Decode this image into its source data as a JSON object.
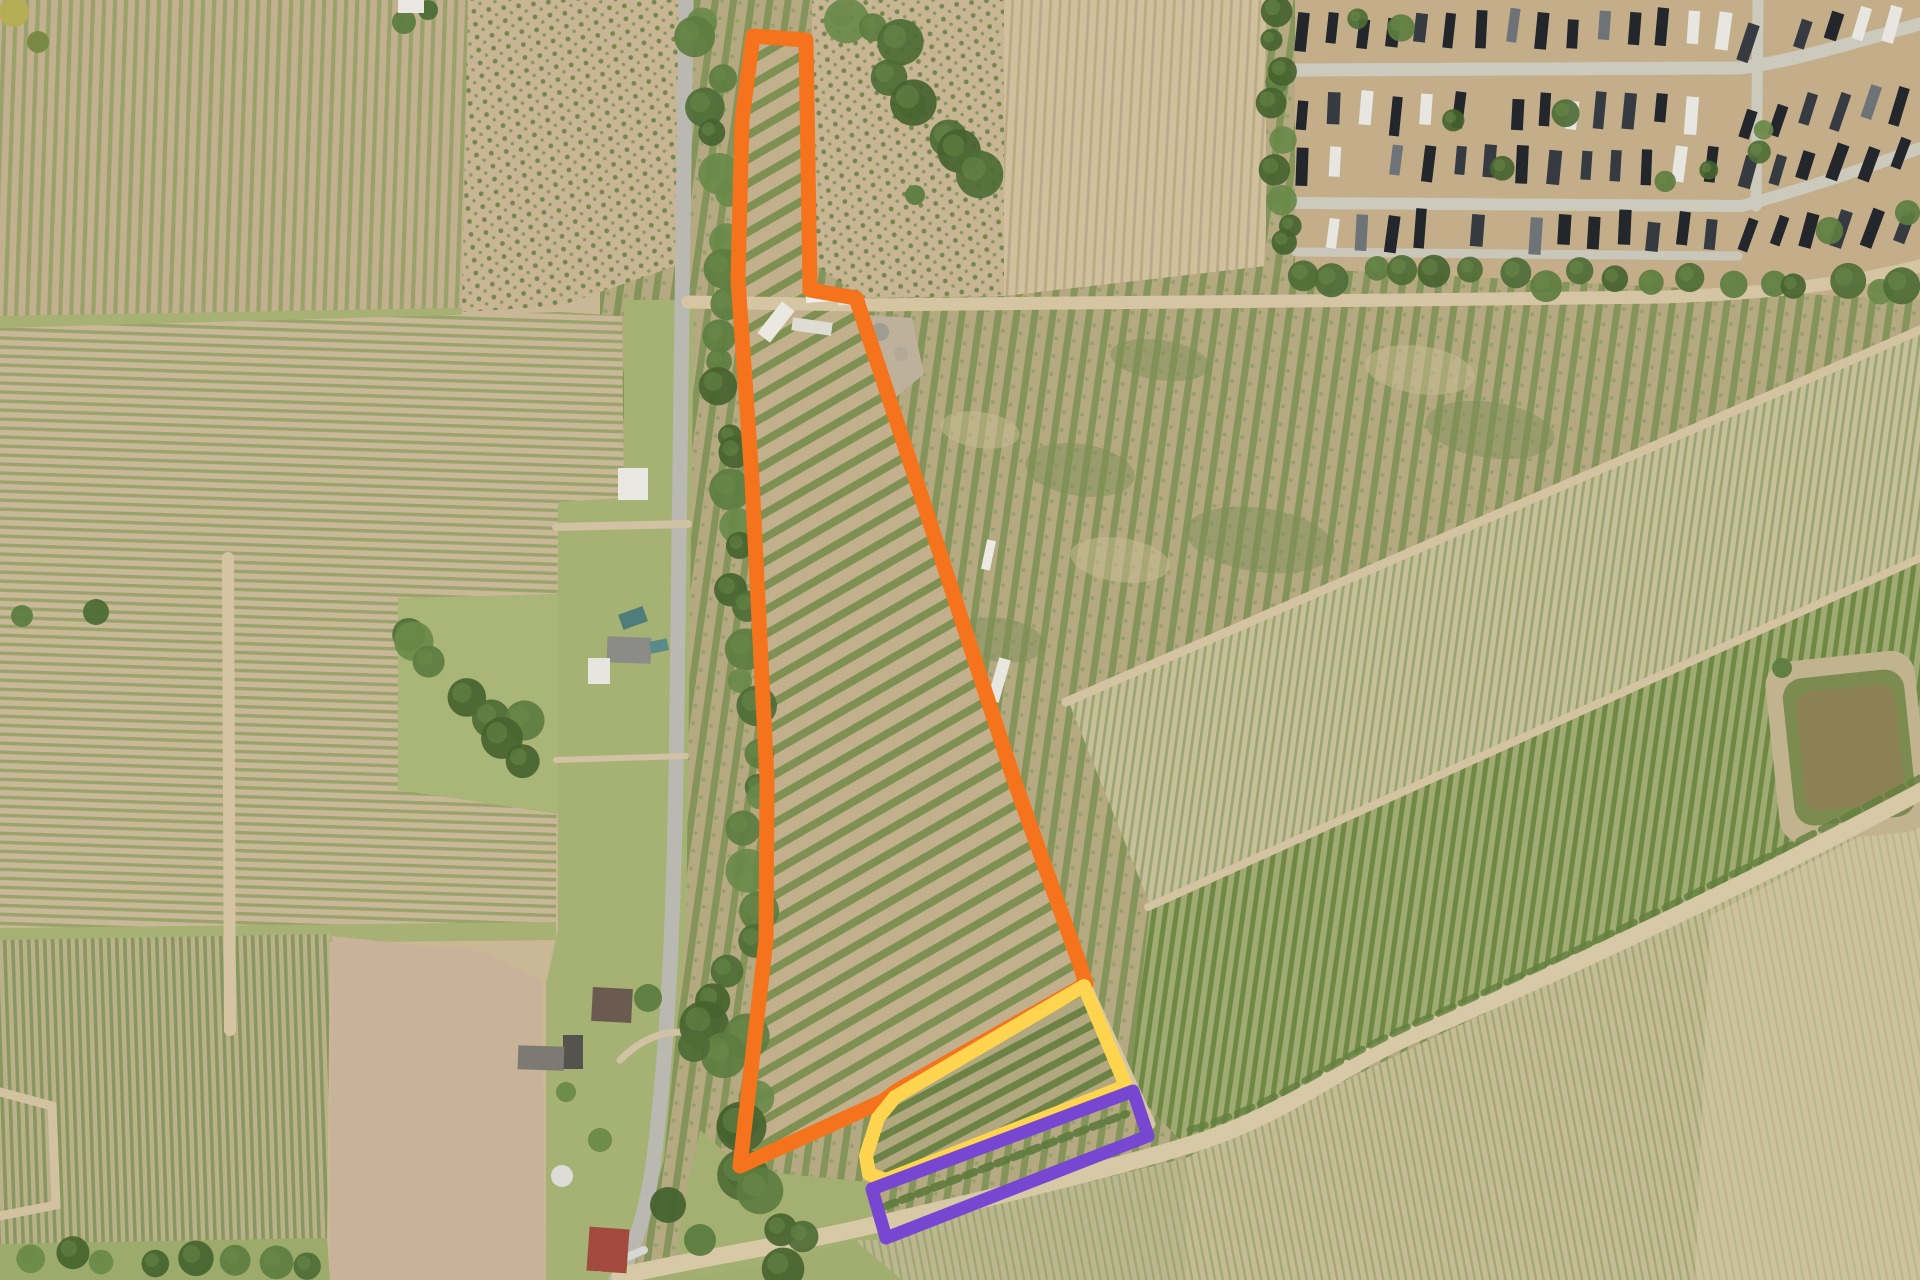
{
  "image": {
    "kind": "satellite-aerial-photo",
    "description": "Aerial farmland view with three highlighted parcel outlines (orange, yellow, purple), vineyard row fields, rural road with houses, trailer park top-right, pond right side",
    "width": 1920,
    "height": 1280
  },
  "palette": {
    "base_tan": "#c9b795",
    "grass": "#a6b274",
    "grass_dark": "#9cab6c",
    "tree_greens": [
      "#4e6d36",
      "#5d7d40",
      "#6a8a4a",
      "#46632f"
    ],
    "paved_road": "#b9b9b2",
    "dirt_road": "#d5c5a3",
    "plowed_pale": "#c9b29a",
    "park_ground": "#c4ae8a",
    "park_road": "#ccc9bd",
    "pond_water": "#8b8155",
    "pond_bank": "#7c8b50",
    "pond_margin": "#c2b38f",
    "gravel": "#bdb19b"
  },
  "overlays": {
    "orange_parcel": {
      "name": "orange-parcel-outline",
      "color": "#f5731c",
      "stroke_width": 15,
      "points": [
        [
          753,
          36
        ],
        [
          806,
          40
        ],
        [
          810,
          290
        ],
        [
          856,
          298
        ],
        [
          916,
          480
        ],
        [
          1014,
          780
        ],
        [
          1080,
          965
        ],
        [
          1086,
          984
        ],
        [
          898,
          1090
        ],
        [
          883,
          1101
        ],
        [
          740,
          1166
        ],
        [
          766,
          940
        ],
        [
          767,
          780
        ],
        [
          752,
          480
        ],
        [
          738,
          280
        ],
        [
          742,
          120
        ]
      ]
    },
    "yellow_parcel": {
      "name": "yellow-parcel-outline",
      "color": "#ffd44f",
      "stroke_width": 14,
      "points": [
        [
          1084,
          986
        ],
        [
          1126,
          1086
        ],
        [
          886,
          1180
        ],
        [
          869,
          1174
        ],
        [
          866,
          1156
        ],
        [
          878,
          1118
        ],
        [
          895,
          1097
        ]
      ]
    },
    "purple_strip": {
      "name": "purple-strip-outline",
      "color": "#7847d2",
      "stroke_width": 13,
      "points": [
        [
          872,
          1189
        ],
        [
          1133,
          1091
        ],
        [
          1148,
          1136
        ],
        [
          886,
          1238
        ]
      ]
    }
  },
  "roads": [
    {
      "name": "main-paved-road",
      "d": "M686,0 C683,240 680,480 677,700 C675,900 669,1030 655,1150 C646,1225 628,1262 616,1280",
      "color": "#b9b9b2",
      "w": 15
    },
    {
      "name": "top-dirt-road",
      "d": "M688,302 L860,305 L1400,300 L1664,297 C1780,293 1856,282 1920,266",
      "color": "#d5c5a3",
      "w": 13
    },
    {
      "name": "bottom-dirt-road",
      "d": "M620,1276 C700,1258 780,1246 852,1230 C1000,1196 1120,1166 1186,1146 C1292,1114 1336,1066 1424,1030 C1560,972 1724,896 1920,792",
      "color": "#d8c9a6",
      "w": 17
    },
    {
      "name": "farm-track",
      "d": "M862,310 L918,484 L1016,786 L1090,994 L1150,1124",
      "color": "#d6c7a4",
      "w": 11
    },
    {
      "name": "field-path-vertical",
      "d": "M228,558 L230,1030",
      "color": "#d4c4a2",
      "w": 12
    },
    {
      "name": "field-path-elbow",
      "d": "M0,1092 L52,1106 L56,1205 L0,1216",
      "color": "#d2c2a0",
      "w": 9
    },
    {
      "name": "diag-field-line-1",
      "d": "M1066,702 L1920,330",
      "color": "#d3c3a1",
      "w": 9
    },
    {
      "name": "diag-field-line-2",
      "d": "M1148,907 L1920,558",
      "color": "#d3c3a1",
      "w": 8
    },
    {
      "name": "driveway-1",
      "d": "M556,527 L688,524",
      "color": "#d0c2a2",
      "w": 8
    },
    {
      "name": "driveway-2",
      "d": "M620,1060 C640,1040 660,1032 680,1032",
      "color": "#d0c2a2",
      "w": 7
    },
    {
      "name": "driveway-3",
      "d": "M600,1268 L644,1250",
      "color": "#d8d8d2",
      "w": 8
    },
    {
      "name": "driveway-4",
      "d": "M556,760 L686,756",
      "color": "#d0c2a2",
      "w": 6
    },
    {
      "name": "park-road-h1",
      "d": "M1296,70 L1740,68 C1800,60 1860,40 1920,24",
      "color": "#ccc9bd",
      "w": 13
    },
    {
      "name": "park-road-h2",
      "d": "M1296,203 L1742,206",
      "color": "#ccc9bd",
      "w": 12
    },
    {
      "name": "park-road-v1",
      "d": "M1758,0 L1756,206",
      "color": "#ccc9bd",
      "w": 11
    },
    {
      "name": "park-road-d1",
      "d": "M1742,206 C1800,190 1862,170 1920,148",
      "color": "#ccc9bd",
      "w": 12
    },
    {
      "name": "park-road-b1",
      "d": "M1296,252 L1738,256",
      "color": "#c9c6ba",
      "w": 9
    },
    {
      "name": "bush-row-along-road",
      "d": "M1190,1130 C1290,1100 1340,1054 1428,1018 C1560,959 1724,882 1920,778",
      "color": "#61803f",
      "w": 7,
      "dash": "16 9",
      "opacity": 0.8
    },
    {
      "name": "purple-strip-bush-row",
      "d": "M886,1206 L1126,1114",
      "color": "#5e7a3d",
      "w": 8,
      "dash": "10 7",
      "opacity": 0.9
    }
  ],
  "trailer_park": {
    "home_colors": {
      "dark1": "#363b41",
      "dark2": "#23272c",
      "white": "#e7e6e1",
      "gray": "#6e7377"
    },
    "rows": [
      {
        "y": 30,
        "x0": 1302,
        "x1": 1736,
        "step": 27,
        "rot": 5,
        "slope": 0
      },
      {
        "y": 112,
        "x0": 1302,
        "x1": 1736,
        "step": 27,
        "rot": 5,
        "slope": 0
      },
      {
        "y": 165,
        "x0": 1302,
        "x1": 1736,
        "step": 28,
        "rot": 5,
        "slope": 0
      },
      {
        "y": 232,
        "x0": 1302,
        "x1": 1736,
        "step": 27,
        "rot": 5,
        "slope": 0
      },
      {
        "y": 38,
        "x0": 1748,
        "x1": 1906,
        "step": 26,
        "rot": 16,
        "slope": -0.12
      },
      {
        "y": 120,
        "x0": 1748,
        "x1": 1906,
        "step": 26,
        "rot": 16,
        "slope": -0.12
      },
      {
        "y": 175,
        "x0": 1748,
        "x1": 1906,
        "step": 27,
        "rot": 18,
        "slope": -0.12
      },
      {
        "y": 238,
        "x0": 1748,
        "x1": 1906,
        "step": 27,
        "rot": 18,
        "slope": -0.1
      }
    ]
  },
  "buildings": [
    {
      "name": "white-building-top-left",
      "x": 398,
      "y": 0,
      "w": 26,
      "h": 13,
      "rot": 0,
      "fill": "#e8e7e1"
    },
    {
      "name": "white-barn",
      "x": 618,
      "y": 468,
      "w": 30,
      "h": 32,
      "rot": 0,
      "fill": "#e9e8e2"
    },
    {
      "name": "gray-roof-house",
      "x": 607,
      "y": 637,
      "w": 44,
      "h": 26,
      "rot": 2,
      "fill": "#8b8b87"
    },
    {
      "name": "white-shed",
      "x": 588,
      "y": 658,
      "w": 22,
      "h": 26,
      "rot": 0,
      "fill": "#e6e5df"
    },
    {
      "name": "teal-tarp-1",
      "x": 620,
      "y": 610,
      "w": 26,
      "h": 16,
      "rot": -20,
      "fill": "#4e7d7a"
    },
    {
      "name": "teal-tarp-2",
      "x": 650,
      "y": 640,
      "w": 18,
      "h": 12,
      "rot": -12,
      "fill": "#5b8a8a"
    },
    {
      "name": "brown-roof-house",
      "x": 592,
      "y": 988,
      "w": 40,
      "h": 34,
      "rot": 3,
      "fill": "#6b5a50"
    },
    {
      "name": "dark-shed",
      "x": 563,
      "y": 1035,
      "w": 20,
      "h": 34,
      "rot": 0,
      "fill": "#55534e"
    },
    {
      "name": "gray-barn",
      "x": 518,
      "y": 1046,
      "w": 46,
      "h": 24,
      "rot": 2,
      "fill": "#7d7a74"
    },
    {
      "name": "red-roof-house",
      "x": 588,
      "y": 1228,
      "w": 40,
      "h": 44,
      "rot": 4,
      "fill": "#a34a3e"
    },
    {
      "name": "white-trailer-1",
      "x": 806,
      "y": 292,
      "w": 28,
      "h": 10,
      "rot": -4,
      "fill": "#efeeee"
    },
    {
      "name": "white-trailer-2",
      "x": 838,
      "y": 296,
      "w": 16,
      "h": 9,
      "rot": -4,
      "fill": "#e2e1dd"
    },
    {
      "name": "white-farm-building-1",
      "x": 768,
      "y": 302,
      "w": 16,
      "h": 40,
      "rot": 38,
      "fill": "#eae8e0"
    },
    {
      "name": "white-farm-building-2",
      "x": 792,
      "y": 320,
      "w": 40,
      "h": 13,
      "rot": 8,
      "fill": "#dfddd3"
    },
    {
      "name": "white-building-track-1",
      "x": 984,
      "y": 540,
      "w": 9,
      "h": 30,
      "rot": 12,
      "fill": "#eceae2"
    },
    {
      "name": "white-building-track-2",
      "x": 993,
      "y": 658,
      "w": 12,
      "h": 44,
      "rot": 16,
      "fill": "#e8e7df"
    }
  ],
  "round_tank": {
    "name": "round-white-tank",
    "cx": 562,
    "cy": 1176,
    "r": 11,
    "fill": "#dedcd6"
  },
  "tree_clusters": [
    {
      "name": "roadside-tree-band",
      "x0": 706,
      "y0": 12,
      "x1": 762,
      "y1": 935,
      "n": 30,
      "rmin": 12,
      "rmax": 22,
      "jx": 14,
      "jy": 12
    },
    {
      "name": "roadside-tree-band-lower",
      "x0": 700,
      "y0": 980,
      "x1": 788,
      "y1": 1268,
      "n": 14,
      "rmin": 15,
      "rmax": 26,
      "jx": 28,
      "jy": 14
    },
    {
      "name": "left-of-road-cluster",
      "x0": 418,
      "y0": 618,
      "x1": 545,
      "y1": 778,
      "n": 8,
      "rmin": 16,
      "rmax": 26,
      "jx": 26,
      "jy": 20
    },
    {
      "name": "bottom-left-strip",
      "x0": 25,
      "y0": 1256,
      "x1": 315,
      "y1": 1262,
      "n": 8,
      "rmin": 12,
      "rmax": 18,
      "jx": 10,
      "jy": 6
    },
    {
      "name": "top-center-cluster",
      "x0": 858,
      "y0": 20,
      "x1": 975,
      "y1": 160,
      "n": 9,
      "rmin": 14,
      "rmax": 24,
      "jx": 22,
      "jy": 16
    },
    {
      "name": "hedgerow",
      "x0": 1272,
      "y0": 15,
      "x1": 1284,
      "y1": 250,
      "n": 9,
      "rmin": 11,
      "rmax": 16,
      "jx": 8,
      "jy": 10
    },
    {
      "name": "below-park-band",
      "x0": 1300,
      "y0": 272,
      "x1": 1910,
      "y1": 286,
      "n": 18,
      "rmin": 12,
      "rmax": 20,
      "jx": 10,
      "jy": 9
    },
    {
      "name": "park-inner-trees",
      "x0": 1320,
      "y0": 40,
      "x1": 1900,
      "y1": 240,
      "n": 12,
      "rmin": 9,
      "rmax": 15,
      "jx": 40,
      "jy": 60
    }
  ],
  "lone_trees": [
    {
      "x": 14,
      "y": 12,
      "r": 15,
      "c": "#b5ae52"
    },
    {
      "x": 38,
      "y": 42,
      "r": 11,
      "c": "#76883f"
    },
    {
      "x": 404,
      "y": 22,
      "r": 12,
      "c": "#5d7d40"
    },
    {
      "x": 428,
      "y": 10,
      "r": 10,
      "c": "#4e6d36"
    },
    {
      "x": 96,
      "y": 612,
      "r": 13,
      "c": "#4e6d36"
    },
    {
      "x": 22,
      "y": 616,
      "r": 11,
      "c": "#5d7d40"
    },
    {
      "x": 648,
      "y": 998,
      "r": 14,
      "c": "#5d7d40"
    },
    {
      "x": 694,
      "y": 1046,
      "r": 16,
      "c": "#4e6d36"
    },
    {
      "x": 600,
      "y": 1140,
      "r": 12,
      "c": "#6a8a4a"
    },
    {
      "x": 668,
      "y": 1205,
      "r": 18,
      "c": "#46632f"
    },
    {
      "x": 700,
      "y": 1240,
      "r": 16,
      "c": "#5d7d40"
    },
    {
      "x": 566,
      "y": 1092,
      "r": 10,
      "c": "#6a8a4a"
    },
    {
      "x": 915,
      "y": 195,
      "r": 10,
      "c": "#5d7d40"
    },
    {
      "x": 1782,
      "y": 668,
      "r": 10,
      "c": "#5d7d40"
    }
  ],
  "pond": {
    "name": "farm-pond",
    "x": 1772,
    "y": 656,
    "w": 150,
    "h": 182,
    "rot": -6
  }
}
